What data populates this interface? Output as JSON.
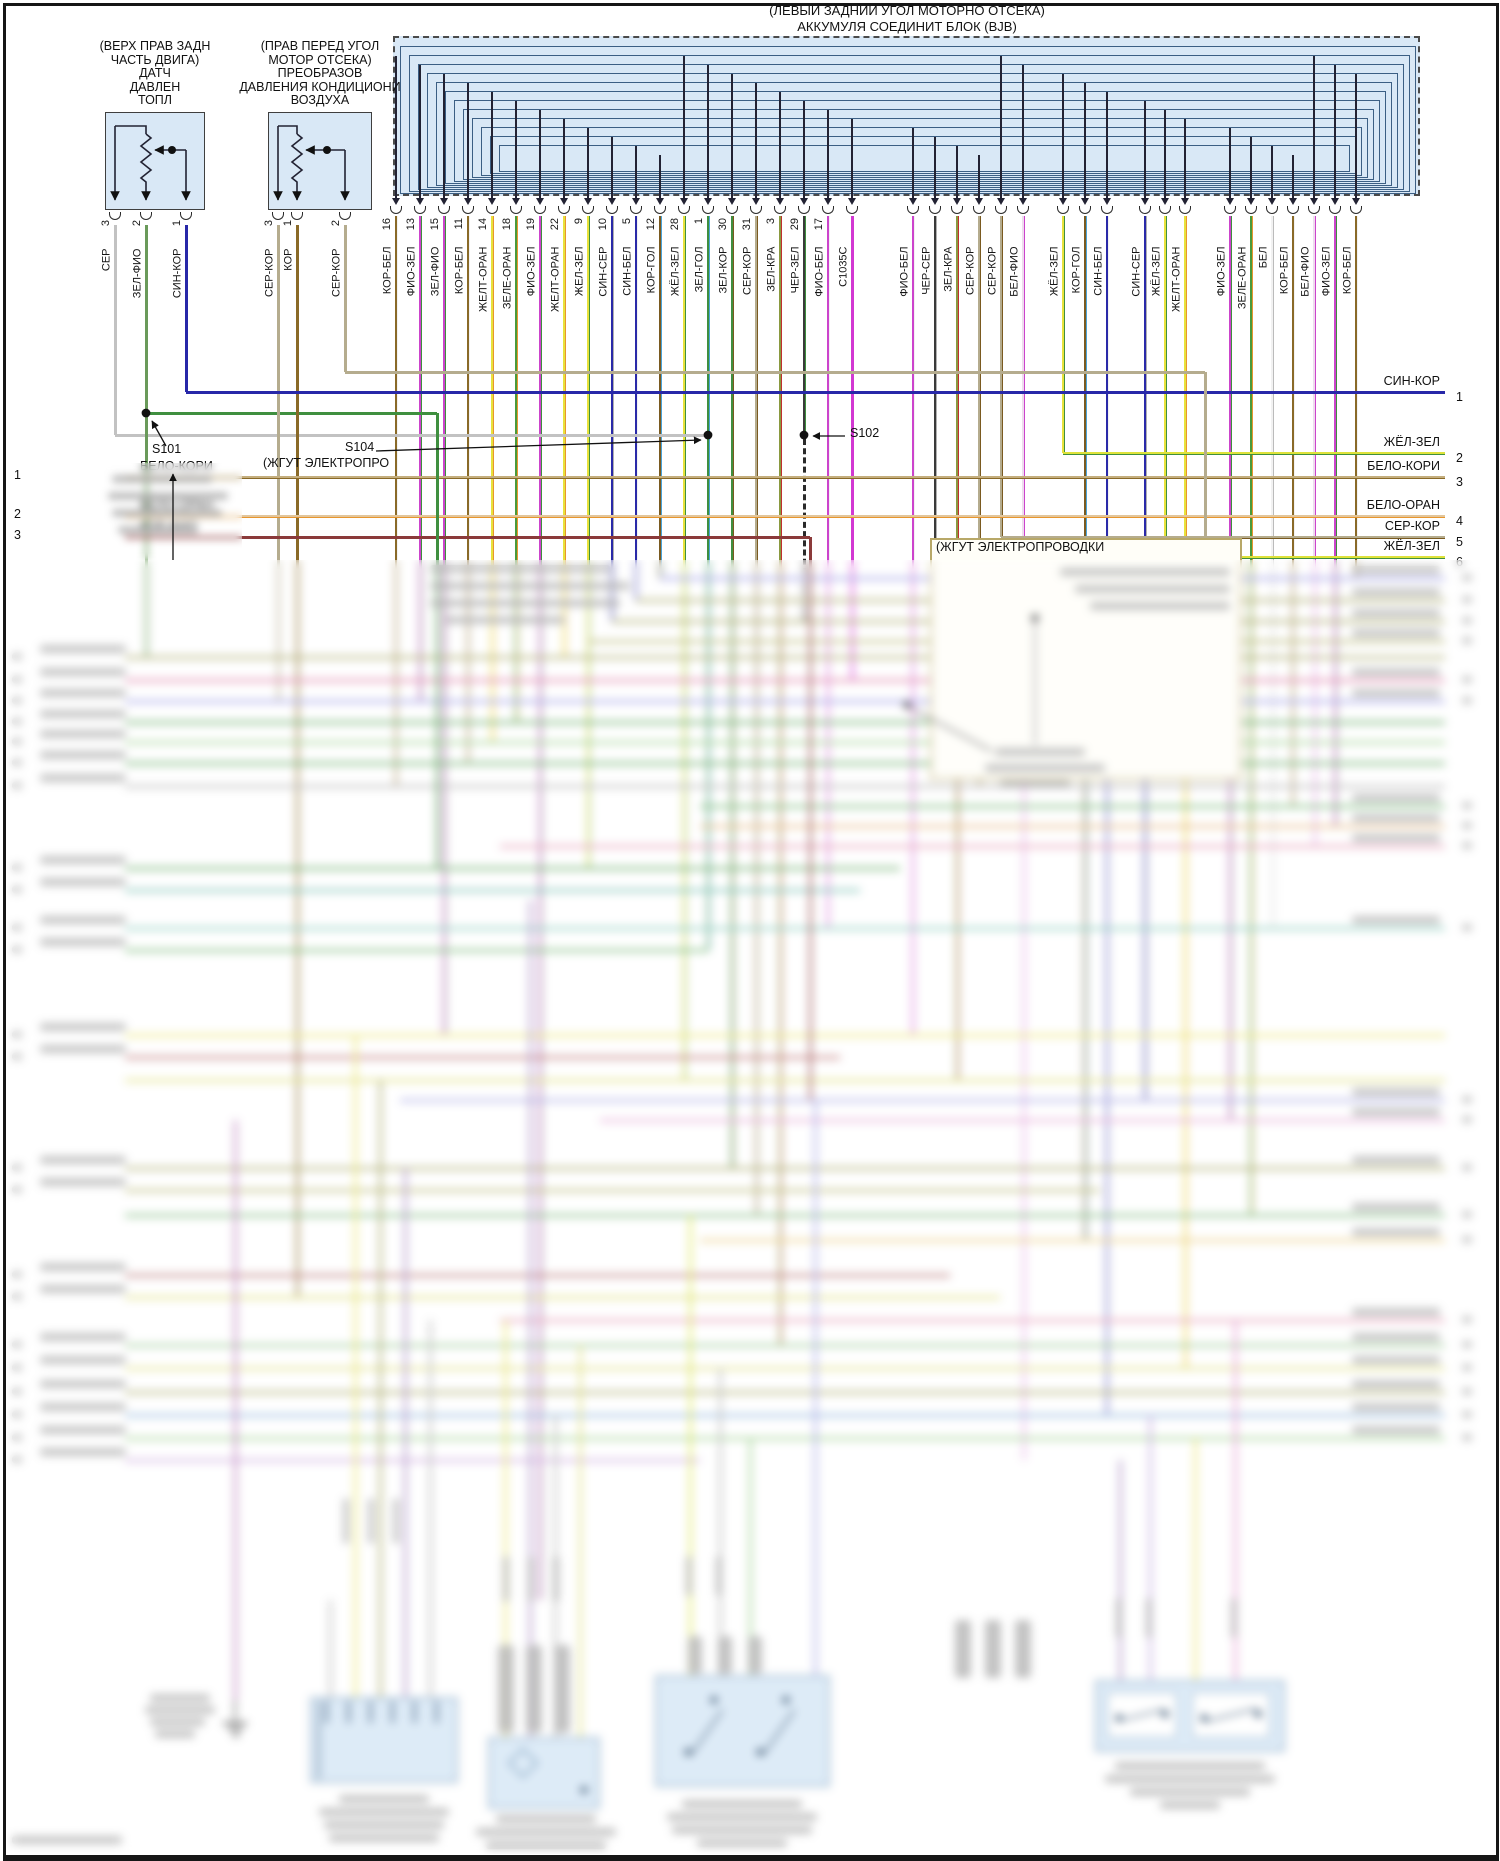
{
  "bjb": {
    "title_line1": "(ЛЕВЫЙ ЗАДНИЙ УГОЛ МОТОРНО ОТСЕКА)",
    "title_line2": "АККУМУЛЯ СОЕДИНИТ БЛОК (BJB)",
    "fill": "#d9e8f6",
    "pins": [
      {
        "l": "КОР-БЕЛ",
        "n": "16",
        "c": "#8a6a28",
        "s": "#f2f2f2",
        "e": 786
      },
      {
        "l": "ФИО-ЗЕЛ",
        "n": "13",
        "c": "#cc44cc",
        "s": "#3f8f3f",
        "e": 701
      },
      {
        "l": "ЗЕЛ-ФИО",
        "n": "15",
        "c": "#cc44cc",
        "s": "#3f8f3f",
        "e": 1035
      },
      {
        "l": "КОР-БЕЛ",
        "n": "11",
        "c": "#8a6a28",
        "s": "#f2f2f2",
        "e": 763
      },
      {
        "l": "ЖЕЛТ-ОРАН",
        "n": "14",
        "c": "#e8e23c",
        "s": "#e8962e",
        "e": 742
      },
      {
        "l": "ЗЕЛЕ-ОРАН",
        "n": "18",
        "c": "#4a9a3a",
        "s": "#e8962e",
        "e": 722
      },
      {
        "l": "ФИО-ЗЕЛ",
        "n": "19",
        "c": "#cc44cc",
        "s": "#3f8f3f",
        "e": 1600
      },
      {
        "l": "ЖЕЛТ-ОРАН",
        "n": "22",
        "c": "#e8e23c",
        "s": "#e8962e",
        "e": 657
      },
      {
        "l": "ЖЕЛ-ЗЕЛ",
        "n": "9",
        "c": "#e8e23c",
        "s": "#3f8f3f",
        "e": 868
      },
      {
        "l": "СИН-СЕР",
        "n": "10",
        "c": "#2a2aa8",
        "s": "#b0b0b0",
        "e": 621
      },
      {
        "l": "СИН-БЕЛ",
        "n": "5",
        "c": "#2a2aa8",
        "s": "#f2f2f2",
        "e": 600
      },
      {
        "l": "КОР-ГОЛ",
        "n": "12",
        "c": "#7a5a20",
        "s": "#4aa3d8",
        "e": 578
      },
      {
        "l": "ЖЁЛ-ЗЕЛ",
        "n": "28",
        "c": "#e8e23c",
        "s": "#3f8f3f",
        "e": 1080
      },
      {
        "l": "ЗЕЛ-ГОЛ",
        "n": "1",
        "c": "#3f8f3f",
        "s": "#4aa3d8",
        "e": 950
      },
      {
        "l": "ЗЕЛ-КОР",
        "n": "30",
        "c": "#3f8f3f",
        "s": "#7a5a20",
        "e": 1168
      },
      {
        "l": "СЕР-КОР",
        "n": "31",
        "c": "#b5ac8e",
        "s": "#7a5a20",
        "e": 1215
      },
      {
        "l": "ЗЕЛ-КРА",
        "n": "3",
        "c": "#8a9a40",
        "s": "#c03030",
        "e": 1345
      },
      {
        "l": "ЧЕР-ЗЕЛ",
        "n": "29",
        "c": "#3a3a3a",
        "s": "#3f8f3f",
        "e": 435
      },
      {
        "l": "ФИО-БЕЛ",
        "n": "17",
        "c": "#cc44cc",
        "s": "#f2f2f2",
        "e": 928
      },
      {
        "l": "C1035C",
        "n": "",
        "c": "#d238d2",
        "s": "#d238d2",
        "e": 680
      },
      {
        "l": "ФИО-БЕЛ",
        "n": "",
        "c": "#cc44cc",
        "s": "#f2f2f2",
        "e": 1035
      },
      {
        "l": "ЧЕР-СЕР",
        "n": "",
        "c": "#3a3a3a",
        "s": "#b0b0b0",
        "e": 620
      },
      {
        "l": "ЗЕЛ-КРА",
        "n": "",
        "c": "#8a9a40",
        "s": "#c03030",
        "e": 1080
      },
      {
        "l": "СЕР-КОР",
        "n": "",
        "c": "#b5ac8e",
        "s": "#7a5a20",
        "e": 786
      },
      {
        "l": "СЕР-КОР",
        "n": "",
        "c": "#b5ac8e",
        "s": "#7a5a20",
        "e": 537
      },
      {
        "l": "БЕЛ-ФИО",
        "n": "",
        "c": "#eedcee",
        "s": "#cc44cc",
        "e": 1460
      },
      {
        "l": "ЖЁЛ-ЗЕЛ",
        "n": "",
        "c": "#e8e23c",
        "s": "#3f8f3f",
        "e": 453
      },
      {
        "l": "КОР-ГОЛ",
        "n": "",
        "c": "#7a5a20",
        "s": "#4aa3d8",
        "e": 1240
      },
      {
        "l": "СИН-БЕЛ",
        "n": "",
        "c": "#2a2aa8",
        "s": "#f2f2f2",
        "e": 1415
      },
      {
        "l": "СИН-СЕР",
        "n": "",
        "c": "#2a2aa8",
        "s": "#b0b0b0",
        "e": 1100
      },
      {
        "l": "ЖЁЛ-ЗЕЛ",
        "n": "",
        "c": "#e8e23c",
        "s": "#3f8f3f",
        "e": 557
      },
      {
        "l": "ЖЕЛТ-ОРАН",
        "n": "",
        "c": "#e8e23c",
        "s": "#e8962e",
        "e": 1368
      },
      {
        "l": "ФИО-ЗЕЛ",
        "n": "",
        "c": "#cc44cc",
        "s": "#3f8f3f",
        "e": 1120
      },
      {
        "l": "ЗЕЛЕ-ОРАН",
        "n": "",
        "c": "#4a9a3a",
        "s": "#e8962e",
        "e": 1215
      },
      {
        "l": "БЕЛ",
        "n": "",
        "c": "#f2f2f2",
        "s": "#bbbbbb",
        "e": 928
      },
      {
        "l": "КОР-БЕЛ",
        "n": "",
        "c": "#8a6a28",
        "s": "#f2f2f2",
        "e": 806
      },
      {
        "l": "БЕЛ-ФИО",
        "n": "",
        "c": "#eedcee",
        "s": "#cc44cc",
        "e": 846
      },
      {
        "l": "ФИО-ЗЕЛ",
        "n": "",
        "c": "#cc44cc",
        "s": "#3f8f3f",
        "e": 826
      },
      {
        "l": "КОР-БЕЛ",
        "n": "",
        "c": "#8a6a28",
        "s": "#f2f2f2",
        "e": 578
      }
    ]
  },
  "components": [
    {
      "label_lines": [
        "(ВЕРХ ПРАВ ЗАДН",
        "ЧАСТЬ ДВИГА)",
        "ДАТЧ",
        "ДАВЛЕН",
        "ТОПЛ"
      ],
      "pins": [
        {
          "num": "3",
          "wire": "СЕР"
        },
        {
          "num": "2",
          "wire": "ЗЕЛ-ФИО"
        },
        {
          "num": "1",
          "wire": "СИН-КОР"
        }
      ]
    },
    {
      "label_lines": [
        "(ПРАВ ПЕРЕД УГОЛ",
        "МОТОР ОТСЕКА)",
        "ПРЕОБРАЗОВ",
        "ДАВЛЕНИЯ КОНДИЦИОНИ",
        "ВОЗДУХА"
      ],
      "pins": [
        {
          "num": "3",
          "wire": "СЕР-КОР"
        },
        {
          "num": "1",
          "wire": "КОР"
        },
        {
          "num": "2",
          "wire": "СЕР-КОР"
        }
      ]
    }
  ],
  "splices": {
    "s101": "S101",
    "s102": "S102",
    "s104": "S104",
    "s104_note": "(ЖГУТ ЭЛЕКТРОПРО",
    "harness_note": "(ЖГУТ ЭЛЕКТРОПРОВОДКИ"
  },
  "left_rows": [
    {
      "num": "1",
      "label": "БЕЛО-КОРИ",
      "y": 477,
      "c": "#c4ae7e"
    },
    {
      "num": "2",
      "label": "БЕЛО-ОРАН",
      "y": 516,
      "c": "#e2c69c"
    },
    {
      "num": "3",
      "label": "КОР-ФИО",
      "y": 537,
      "c": "#8b3a3a"
    }
  ],
  "right_rows": [
    {
      "num": "1",
      "label": "СИН-КОР",
      "y": 392,
      "x1": 186,
      "c": "#2828a8",
      "s": "#2828a8"
    },
    {
      "num": "2",
      "label": "ЖЁЛ-ЗЕЛ",
      "y": 453,
      "x1": 1063,
      "c": "#dde23a",
      "s": "#3f8f3f"
    },
    {
      "num": "3",
      "label": "БЕЛО-КОРИ",
      "y": 477,
      "x1": 125,
      "c": "#c4ae7e",
      "s": "#8a6a28"
    },
    {
      "num": "4",
      "label": "БЕЛО-ОРАН",
      "y": 516,
      "x1": 125,
      "c": "#e2c69c",
      "s": "#e8962e"
    },
    {
      "num": "5",
      "label": "СЕР-КОР",
      "y": 537,
      "x1": 1001,
      "c": "#b5ac8e",
      "s": "#7a5a20"
    },
    {
      "num": "6",
      "label": "ЖЁЛ-ЗЕЛ",
      "y": 557,
      "x1": 1165,
      "c": "#dde23a",
      "s": "#3f8f3f"
    }
  ],
  "sharp_extra": {
    "h": [
      [
        372,
        345,
        1205,
        "#b5ac8e"
      ],
      [
        435,
        115,
        708,
        "#c2c2c2"
      ],
      [
        413,
        146,
        437,
        "#3f8f3f"
      ]
    ],
    "v": [
      [
        115,
        225,
        435,
        "#c2c2c2"
      ],
      [
        146,
        225,
        657,
        "#6a9a5a"
      ],
      [
        186,
        225,
        392,
        "#2828a8"
      ],
      [
        278,
        225,
        700,
        "#b5ac8e"
      ],
      [
        297,
        225,
        1297,
        "#8a6a28"
      ],
      [
        345,
        225,
        372,
        "#b5ac8e"
      ]
    ]
  },
  "blurred_zone": {
    "rows": [
      [
        578,
        660,
        1445,
        "#8a8ae0",
        0,
        1
      ],
      [
        600,
        636,
        1445,
        "#9a9a50",
        0,
        1
      ],
      [
        621,
        612,
        1445,
        "#9a9a50",
        0,
        1
      ],
      [
        641,
        588,
        1445,
        "#a8a858",
        0,
        1
      ],
      [
        657,
        125,
        1445,
        "#9a9a50",
        1,
        0
      ],
      [
        680,
        125,
        1445,
        "#d86898",
        1,
        1
      ],
      [
        701,
        125,
        1445,
        "#8a8ae0",
        1,
        1
      ],
      [
        722,
        125,
        1445,
        "#4a9a4a",
        1,
        0
      ],
      [
        742,
        125,
        1445,
        "#8cc87c",
        1,
        0
      ],
      [
        763,
        125,
        1445,
        "#4a9a4a",
        1,
        0
      ],
      [
        786,
        125,
        1445,
        "#a8a8a8",
        1,
        0
      ],
      [
        806,
        700,
        1445,
        "#5aaa5a",
        0,
        1
      ],
      [
        826,
        700,
        1445,
        "#e0aa6a",
        0,
        1
      ],
      [
        846,
        500,
        1445,
        "#e08aa8",
        0,
        1
      ],
      [
        868,
        125,
        900,
        "#4a9a4a",
        1,
        0
      ],
      [
        890,
        125,
        860,
        "#58b0a0",
        1,
        0
      ],
      [
        928,
        125,
        1445,
        "#70bfae",
        1,
        1
      ],
      [
        950,
        125,
        708,
        "#5aaa5a",
        1,
        0
      ],
      [
        1035,
        125,
        1445,
        "#e6e05a",
        1,
        0
      ],
      [
        1057,
        125,
        840,
        "#b05858",
        1,
        0
      ],
      [
        1080,
        125,
        1445,
        "#d8d862",
        0,
        0
      ],
      [
        1100,
        400,
        1445,
        "#9a9ae0",
        0,
        1
      ],
      [
        1120,
        600,
        1445,
        "#e09ad0",
        0,
        1
      ],
      [
        1168,
        125,
        1445,
        "#9a9a50",
        1,
        1
      ],
      [
        1190,
        125,
        1100,
        "#aaaa58",
        1,
        0
      ],
      [
        1215,
        125,
        1445,
        "#62aa62",
        0,
        1
      ],
      [
        1240,
        700,
        1445,
        "#e6c46a",
        0,
        1
      ],
      [
        1275,
        125,
        950,
        "#a85858",
        1,
        0
      ],
      [
        1297,
        125,
        1000,
        "#d6d662",
        1,
        0
      ],
      [
        1320,
        500,
        1445,
        "#e08aa8",
        0,
        1
      ],
      [
        1345,
        125,
        1445,
        "#84bc7c",
        1,
        1
      ],
      [
        1368,
        125,
        1445,
        "#d8d86a",
        1,
        1
      ],
      [
        1392,
        125,
        1445,
        "#9a9a50",
        1,
        1
      ],
      [
        1415,
        125,
        1445,
        "#74a4d4",
        1,
        1
      ],
      [
        1438,
        125,
        1445,
        "#8cc87c",
        1,
        1
      ],
      [
        1460,
        125,
        700,
        "#c49ad8",
        1,
        0
      ]
    ],
    "verts": [
      [
        437,
        413,
        868,
        "#3f8f3f"
      ],
      [
        810,
        537,
        1100,
        "#8b3a3a"
      ],
      [
        1205,
        372,
        600,
        "#b5ac8e"
      ],
      [
        235,
        1120,
        1700,
        "#b06ab0"
      ],
      [
        330,
        1600,
        1697,
        "#b0b0b0"
      ],
      [
        355,
        1035,
        1697,
        "#e6e05a"
      ],
      [
        380,
        1080,
        1697,
        "#9a9a50"
      ],
      [
        405,
        1168,
        1697,
        "#9a7ab8"
      ],
      [
        430,
        1320,
        1697,
        "#b0b0b0"
      ],
      [
        505,
        1320,
        1737,
        "#e6e05a"
      ],
      [
        530,
        900,
        1737,
        "#9a7ab8"
      ],
      [
        555,
        1415,
        1737,
        "#b0b0b0"
      ],
      [
        580,
        1345,
        1737,
        "#d8d86a"
      ],
      [
        690,
        1215,
        1675,
        "#d6e23a"
      ],
      [
        720,
        1368,
        1675,
        "#b0b0b0"
      ],
      [
        750,
        1438,
        1675,
        "#8cc87c"
      ],
      [
        815,
        1100,
        1675,
        "#9a9ae0"
      ],
      [
        1120,
        1460,
        1680,
        "#9a7ab8"
      ],
      [
        1150,
        1415,
        1680,
        "#b89ad8"
      ],
      [
        1195,
        1438,
        1680,
        "#e6e05a"
      ],
      [
        1235,
        1320,
        1680,
        "#e08ac8"
      ]
    ],
    "dash_vert": [
      804,
      439,
      620,
      "#2a2a2a"
    ],
    "note_box": [
      930,
      538,
      312,
      242
    ],
    "boxes": [
      [
        310,
        1697,
        148,
        86
      ],
      [
        488,
        1737,
        112,
        72
      ],
      [
        655,
        1675,
        175,
        112
      ],
      [
        1095,
        1680,
        190,
        72
      ]
    ],
    "gray_blocks": [
      [
        498,
        1645,
        16,
        88
      ],
      [
        526,
        1645,
        16,
        88
      ],
      [
        554,
        1645,
        16,
        88
      ],
      [
        688,
        1636,
        14,
        38
      ],
      [
        718,
        1636,
        14,
        38
      ],
      [
        748,
        1636,
        14,
        38
      ],
      [
        955,
        1620,
        16,
        58
      ],
      [
        985,
        1620,
        16,
        58
      ],
      [
        1015,
        1620,
        16,
        58
      ]
    ],
    "vblobs": [
      [
        343,
        1498,
        6,
        46
      ],
      [
        368,
        1498,
        6,
        46
      ],
      [
        393,
        1498,
        6,
        46
      ],
      [
        503,
        1556,
        6,
        46
      ],
      [
        528,
        1556,
        6,
        46
      ],
      [
        553,
        1556,
        6,
        46
      ],
      [
        686,
        1556,
        6,
        40
      ],
      [
        716,
        1556,
        6,
        40
      ],
      [
        1116,
        1598,
        6,
        40
      ],
      [
        1146,
        1598,
        6,
        40
      ],
      [
        1231,
        1598,
        6,
        40
      ]
    ],
    "tblobs": [
      [
        112,
        475,
        100
      ],
      [
        108,
        492,
        120
      ],
      [
        112,
        509,
        110
      ],
      [
        118,
        526,
        80
      ],
      [
        430,
        565,
        180
      ],
      [
        430,
        582,
        200
      ],
      [
        430,
        599,
        190
      ],
      [
        445,
        616,
        120
      ],
      [
        1060,
        568,
        170
      ],
      [
        1075,
        585,
        155
      ],
      [
        1090,
        602,
        140
      ],
      [
        995,
        748,
        90
      ],
      [
        985,
        764,
        120
      ],
      [
        1000,
        780,
        70
      ],
      [
        339,
        1795,
        90
      ],
      [
        319,
        1808,
        130
      ],
      [
        324,
        1821,
        120
      ],
      [
        329,
        1834,
        110
      ],
      [
        496,
        1815,
        100
      ],
      [
        476,
        1828,
        140
      ],
      [
        486,
        1841,
        120
      ],
      [
        682,
        1800,
        120
      ],
      [
        667,
        1813,
        150
      ],
      [
        672,
        1826,
        140
      ],
      [
        697,
        1839,
        90
      ],
      [
        1115,
        1762,
        150
      ],
      [
        1105,
        1775,
        170
      ],
      [
        1130,
        1788,
        120
      ],
      [
        1160,
        1801,
        60
      ],
      [
        150,
        1694,
        60
      ],
      [
        145,
        1706,
        70
      ],
      [
        150,
        1718,
        55
      ],
      [
        155,
        1730,
        40
      ],
      [
        12,
        1836,
        110
      ]
    ],
    "dots": [
      [
        1035,
        618
      ],
      [
        907,
        705
      ]
    ]
  }
}
